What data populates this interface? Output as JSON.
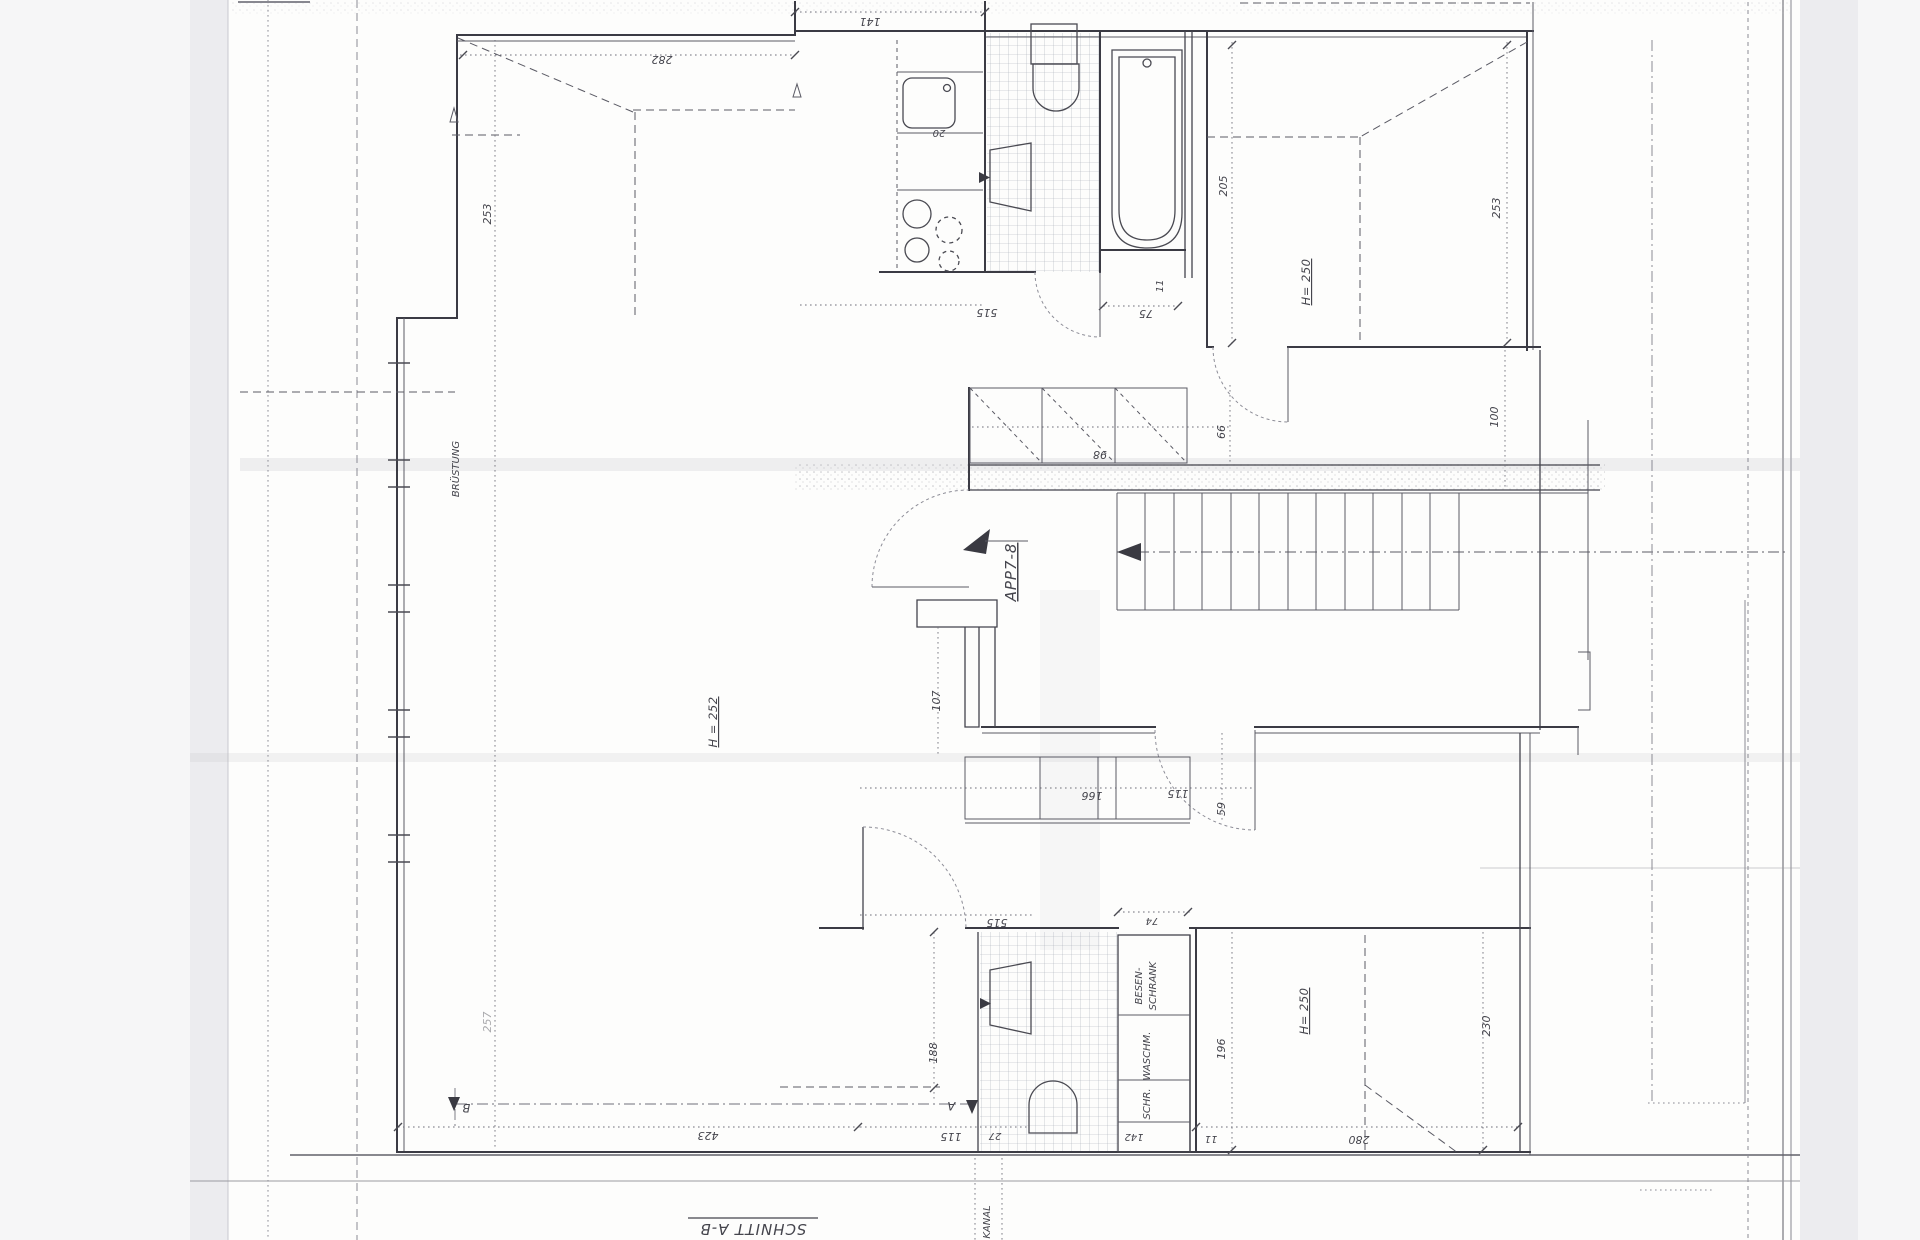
{
  "plan": {
    "apartment_label": "APP7-8",
    "section_title": "SCHNITT A-B",
    "markers": {
      "a": "A",
      "b": "B"
    },
    "rooms": {
      "bruestung": "BRÜSTUNG",
      "kanal": "KANAL",
      "besen_line1": "BESEN-",
      "besen_line2": "SCHRANK",
      "waschm": "WASCHM.",
      "schr": "SCHR.",
      "h252": "H = 252",
      "h250_top": "H= 250",
      "h250_bottom": "H= 250"
    },
    "dims": {
      "d141": "141",
      "d282": "282",
      "d253_left": "253",
      "d20": "20",
      "d205": "205",
      "d253_right": "253",
      "d75": "75",
      "d11_top": "11",
      "d515_top": "515",
      "d66": "66",
      "d98": "98",
      "d100": "100",
      "d107": "107",
      "d166": "166",
      "d115_mid": "115",
      "d59": "59",
      "d515_bottom": "515",
      "d74": "74",
      "d188": "188",
      "d115_bottom": "115",
      "d27": "27",
      "d142": "142",
      "d196": "196",
      "d230": "230",
      "d280": "280",
      "d11_bottom": "11",
      "d423": "423",
      "d257": "257"
    }
  }
}
